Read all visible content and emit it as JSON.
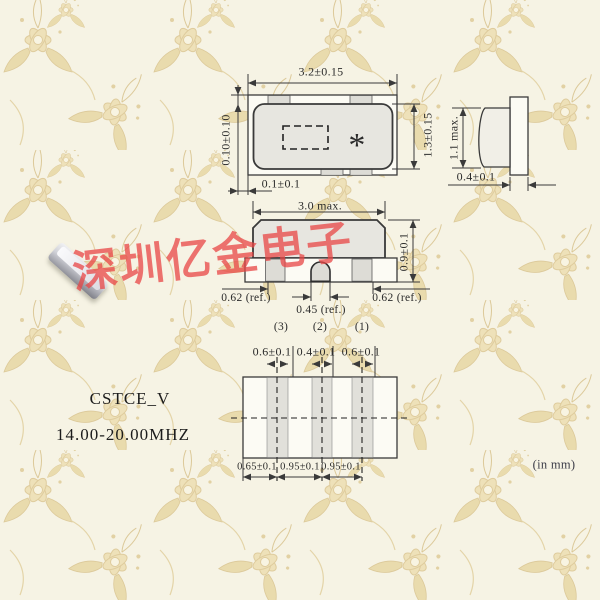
{
  "watermark": {
    "text": "深圳亿金电子",
    "color": "#e84646"
  },
  "product": {
    "series": "CSTCE_V",
    "freq_range": "14.00-20.00MHZ"
  },
  "units_note": "(in mm)",
  "top_view": {
    "width": "3.2±0.15",
    "height": "1.3±0.15",
    "top_margin": "0.10±0.10",
    "side_margin": "0.1±0.1",
    "marking": "*"
  },
  "side_view": {
    "height": "1.1 max.",
    "terminal_width": "0.4±0.1"
  },
  "front_view": {
    "width": "3.0 max.",
    "height": "0.9±0.1",
    "pad_left": "0.62 (ref.)",
    "pad_center": "0.45 (ref.)",
    "pad_right": "0.62 (ref.)",
    "pins": [
      "(3)",
      "(2)",
      "(1)"
    ]
  },
  "land_pattern": {
    "top_dims": [
      "0.6±0.1",
      "0.4±0.1",
      "0.6±0.1"
    ],
    "bottom_dims": [
      "0.65±0.1",
      "0.95±0.1",
      "0.95±0.1"
    ]
  },
  "colors": {
    "background": "#f5f2e3",
    "pattern_tan": "#e6d5a5",
    "line": "#3a3a3a",
    "body_fill": "#e7e6e0",
    "watermark_red": "#e84646"
  }
}
